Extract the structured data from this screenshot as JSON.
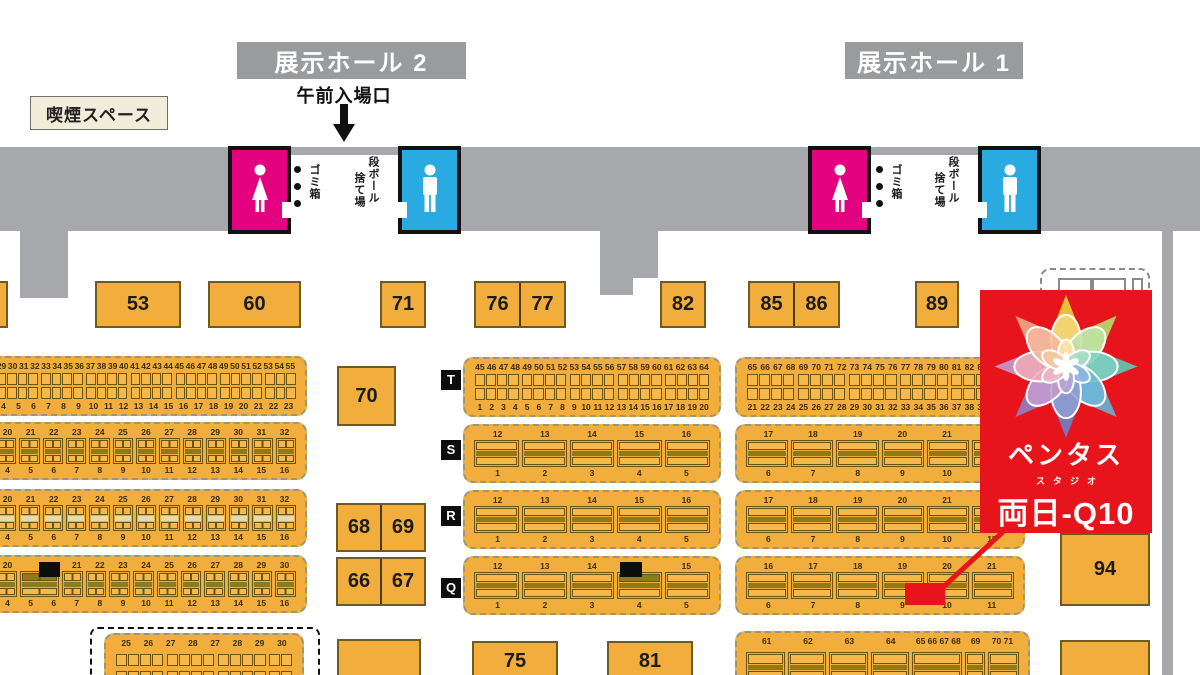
{
  "halls": {
    "hall2_label": "展示ホール 2",
    "hall1_label": "展示ホール 1"
  },
  "labels": {
    "smoking": "喫煙スペース",
    "entrance": "午前入場口",
    "trash": "ゴミ箱",
    "cardboard_line1": "段ボール",
    "cardboard_line2": "捨て場"
  },
  "exhibitor_card": {
    "name": "ペンタス",
    "subtitle": "スタジオ",
    "booth_label": "両日-Q10",
    "bg_color": "#e8141c"
  },
  "colors": {
    "booth_orange": "#f2ae3c",
    "corridor_gray": "#a6a8ab",
    "hall_label_gray": "#9a9b9d",
    "female_pink": "#e3017f",
    "male_blue": "#29abe2",
    "highlight_red": "#e8141c",
    "smoking_cream": "#f2edda",
    "stripe_olive": "#8d7a1b"
  },
  "icons": {
    "female": "female-restroom-icon",
    "male": "male-restroom-icon",
    "arrow": "entrance-down-arrow",
    "dots": "trash-bin-dots",
    "truck": "loading-area-outline"
  },
  "row_labels": [
    {
      "label": "T",
      "x": 441,
      "y": 370
    },
    {
      "label": "S",
      "x": 441,
      "y": 440
    },
    {
      "label": "R",
      "x": 441,
      "y": 506
    },
    {
      "label": "Q",
      "x": 441,
      "y": 578
    }
  ],
  "big_booths": [
    {
      "labels": [],
      "x": -35,
      "y": 281,
      "w": 43,
      "h": 47
    },
    {
      "labels": [
        "53"
      ],
      "x": 95,
      "y": 281,
      "w": 86,
      "h": 47
    },
    {
      "labels": [
        "60"
      ],
      "x": 208,
      "y": 281,
      "w": 93,
      "h": 47
    },
    {
      "labels": [
        "71"
      ],
      "x": 380,
      "y": 281,
      "w": 46,
      "h": 47
    },
    {
      "labels": [
        "76",
        "77"
      ],
      "x": 474,
      "y": 281,
      "w": 92,
      "h": 47
    },
    {
      "labels": [
        "82"
      ],
      "x": 660,
      "y": 281,
      "w": 46,
      "h": 47
    },
    {
      "labels": [
        "85",
        "86"
      ],
      "x": 748,
      "y": 281,
      "w": 92,
      "h": 47
    },
    {
      "labels": [
        "89"
      ],
      "x": 915,
      "y": 281,
      "w": 44,
      "h": 47
    },
    {
      "labels": [
        "70"
      ],
      "x": 337,
      "y": 366,
      "w": 59,
      "h": 60
    },
    {
      "labels": [
        "68",
        "69"
      ],
      "x": 336,
      "y": 503,
      "w": 90,
      "h": 49
    },
    {
      "labels": [
        "66",
        "67"
      ],
      "x": 336,
      "y": 557,
      "w": 90,
      "h": 49
    },
    {
      "labels": [
        "75"
      ],
      "x": 472,
      "y": 641,
      "w": 86,
      "h": 40
    },
    {
      "labels": [
        "81"
      ],
      "x": 607,
      "y": 641,
      "w": 86,
      "h": 40
    },
    {
      "labels": [],
      "x": 337,
      "y": 639,
      "w": 84,
      "h": 42
    },
    {
      "labels": [
        "94"
      ],
      "x": 1060,
      "y": 533,
      "w": 90,
      "h": 73
    },
    {
      "labels": [],
      "x": 1060,
      "y": 640,
      "w": 90,
      "h": 41
    }
  ],
  "booth_pillars": [
    {
      "x": 39,
      "y": 562,
      "w": 21,
      "h": 15
    },
    {
      "x": 620,
      "y": 562,
      "w": 22,
      "h": 15
    }
  ],
  "strips": [
    {
      "id": "L1",
      "type": "dense",
      "x": -15,
      "y": 356,
      "w": 322,
      "h": 60,
      "cols": 27,
      "top": [
        "29",
        "30",
        "31",
        "32",
        "33",
        "34",
        "35",
        "36",
        "37",
        "38",
        "39",
        "40",
        "41",
        "42",
        "43",
        "44",
        "45",
        "46",
        "47",
        "48",
        "49",
        "50",
        "51",
        "52",
        "53",
        "54",
        "55"
      ],
      "bottom": [
        "4",
        "5",
        "6",
        "7",
        "8",
        "9",
        "10",
        "11",
        "12",
        "13",
        "14",
        "15",
        "16",
        "17",
        "18",
        "19",
        "20",
        "21",
        "22",
        "23"
      ]
    },
    {
      "id": "L2",
      "type": "wide",
      "x": -15,
      "y": 422,
      "w": 322,
      "h": 58,
      "divided": true,
      "top": [
        "20",
        "21",
        "22",
        "23",
        "24",
        "25",
        "26",
        "27",
        "28",
        "29",
        "30",
        "31",
        "32"
      ],
      "bottom": [
        "4",
        "5",
        "6",
        "7",
        "8",
        "9",
        "10",
        "11",
        "12",
        "13",
        "14",
        "15",
        "16"
      ]
    },
    {
      "id": "L3",
      "type": "wide",
      "x": -15,
      "y": 489,
      "w": 322,
      "h": 58,
      "divided": true,
      "light": true,
      "top": [
        "20",
        "21",
        "22",
        "23",
        "24",
        "25",
        "26",
        "27",
        "28",
        "29",
        "30",
        "31",
        "32"
      ],
      "bottom": [
        "4",
        "5",
        "6",
        "7",
        "8",
        "9",
        "10",
        "11",
        "12",
        "13",
        "14",
        "15",
        "16"
      ]
    },
    {
      "id": "L4",
      "type": "wide",
      "x": -15,
      "y": 555,
      "w": 322,
      "h": 58,
      "divided": true,
      "dark": 1,
      "widths": [
        1,
        2,
        1,
        1,
        1,
        1,
        1,
        1,
        1,
        1,
        1,
        1
      ],
      "top": [
        "20",
        "",
        "21",
        "22",
        "23",
        "24",
        "25",
        "26",
        "27",
        "28",
        "29",
        "30"
      ],
      "bottom": [
        "4",
        "5",
        "6",
        "7",
        "8",
        "9",
        "10",
        "11",
        "12",
        "13",
        "14",
        "15",
        "16"
      ]
    },
    {
      "id": "TL",
      "type": "dense",
      "x": 463,
      "y": 357,
      "w": 258,
      "h": 60,
      "cols": 20,
      "top": [
        "45",
        "46",
        "47",
        "48",
        "49",
        "50",
        "51",
        "52",
        "53",
        "54",
        "55",
        "56",
        "57",
        "58",
        "59",
        "60",
        "61",
        "62",
        "63",
        "64"
      ],
      "bottom": [
        "1",
        "2",
        "3",
        "4",
        "5",
        "6",
        "7",
        "8",
        "9",
        "10",
        "11",
        "12",
        "13",
        "14",
        "15",
        "16",
        "17",
        "18",
        "19",
        "20"
      ]
    },
    {
      "id": "TR",
      "type": "dense",
      "x": 735,
      "y": 357,
      "w": 290,
      "h": 60,
      "cols": 21,
      "top": [
        "65",
        "66",
        "67",
        "68",
        "69",
        "70",
        "71",
        "72",
        "73",
        "74",
        "75",
        "76",
        "77",
        "78",
        "79",
        "80",
        "81",
        "82",
        "83",
        "84",
        "85"
      ],
      "bottom": [
        "21",
        "22",
        "23",
        "24",
        "25",
        "26",
        "27",
        "28",
        "29",
        "30",
        "31",
        "32",
        "33",
        "34",
        "35",
        "36",
        "37",
        "38",
        "39",
        "40",
        "41"
      ]
    },
    {
      "id": "SL",
      "type": "wide",
      "x": 463,
      "y": 424,
      "w": 258,
      "h": 59,
      "top": [
        "12",
        "13",
        "14",
        "15",
        "16"
      ],
      "bottom": [
        "1",
        "2",
        "3",
        "4",
        "5"
      ]
    },
    {
      "id": "SR",
      "type": "wide",
      "x": 735,
      "y": 424,
      "w": 290,
      "h": 59,
      "top": [
        "17",
        "18",
        "19",
        "20",
        "21",
        ""
      ],
      "bottom": [
        "6",
        "7",
        "8",
        "9",
        "10",
        ""
      ]
    },
    {
      "id": "RL",
      "type": "wide",
      "x": 463,
      "y": 490,
      "w": 258,
      "h": 59,
      "top": [
        "12",
        "13",
        "14",
        "15",
        "16"
      ],
      "bottom": [
        "1",
        "2",
        "3",
        "4",
        "5"
      ]
    },
    {
      "id": "RR",
      "type": "wide",
      "x": 735,
      "y": 490,
      "w": 290,
      "h": 59,
      "top": [
        "17",
        "18",
        "19",
        "20",
        "21",
        ""
      ],
      "bottom": [
        "6",
        "7",
        "8",
        "9",
        "10",
        "11"
      ]
    },
    {
      "id": "QL",
      "type": "wide",
      "x": 463,
      "y": 556,
      "w": 258,
      "h": 59,
      "dark": 3,
      "top": [
        "12",
        "13",
        "14",
        "",
        "15"
      ],
      "bottom": [
        "1",
        "2",
        "3",
        "4",
        "5"
      ]
    },
    {
      "id": "QR",
      "type": "wide",
      "x": 735,
      "y": 556,
      "w": 290,
      "h": 59,
      "top": [
        "16",
        "17",
        "18",
        "19",
        "20",
        "21"
      ],
      "bottom": [
        "6",
        "7",
        "8",
        "9",
        "10",
        "11"
      ]
    },
    {
      "id": "L5",
      "type": "dense",
      "x": 104,
      "y": 633,
      "w": 200,
      "h": 55,
      "cols": 14,
      "top": [
        "25",
        "26",
        "27",
        "28",
        "27",
        "28",
        "29",
        "30"
      ],
      "bottom": []
    },
    {
      "id": "BR",
      "type": "wide",
      "x": 735,
      "y": 631,
      "w": 295,
      "h": 55,
      "widths": [
        2,
        2,
        2,
        2,
        2.6,
        1,
        1.6
      ],
      "top": [
        "61",
        "62",
        "63",
        "64",
        "65 66 67 68",
        "69",
        "70 71"
      ],
      "bottom": []
    }
  ]
}
